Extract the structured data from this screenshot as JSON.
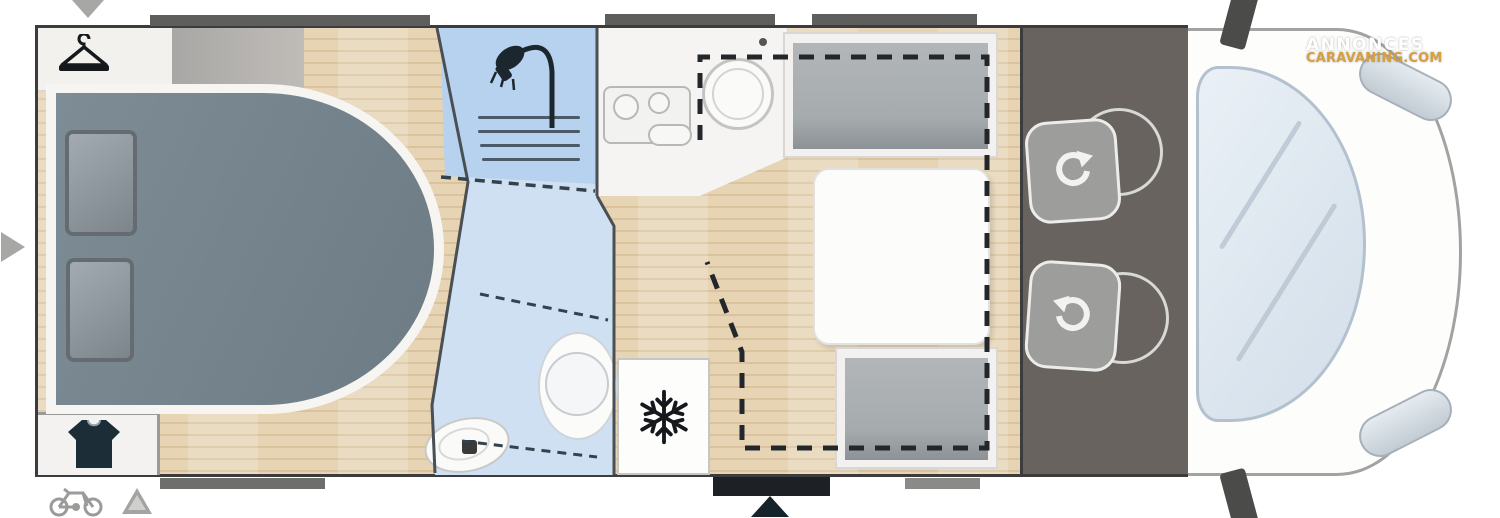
{
  "watermark": {
    "line1": "ANNONCES",
    "line2": "CARAVANING.COM",
    "line1_color": "#ffffff",
    "line2_color": "#d79f3e"
  },
  "palette": {
    "wood_floor": "#e0cba9",
    "bathroom_blue": "#cfe0f2",
    "shower_blue": "#b7d2ee",
    "bed_gray": "#75838d",
    "seat_gray": "#a6abae",
    "cab_dark": "#696360",
    "outline_dark": "#3c3c3c",
    "window_bar": "#5e5e5c",
    "entry_door": "#1d2126",
    "marker_gray": "#a7a7a5",
    "windshield": "#d8e3ee"
  },
  "floorplan": {
    "orientation": "cab-on-right",
    "areas": [
      "bedroom",
      "shower",
      "washroom",
      "kitchen",
      "dinette",
      "refrigerator",
      "cab",
      "vehicle-front"
    ],
    "furniture_icons": [
      "hanger-icon",
      "shirt-icon",
      "shower-head-icon",
      "snowflake-icon",
      "swivel-arrow-icon",
      "bicycle-icon",
      "triangle-marker-icon",
      "entry-arrow-icon",
      "down-arrow-icon",
      "right-arrow-icon"
    ],
    "features": [
      "island-bed",
      "pillows",
      "wardrobes",
      "shower-grate",
      "toilet",
      "washbasin",
      "cooktop-two-burners",
      "round-sink",
      "dinette-table",
      "rear-bench",
      "front-bench",
      "drop-down-bed-dashed-outline",
      "two-swivel-cab-seats",
      "windshield",
      "headlights",
      "side-mirrors",
      "entry-door",
      "windows"
    ]
  }
}
